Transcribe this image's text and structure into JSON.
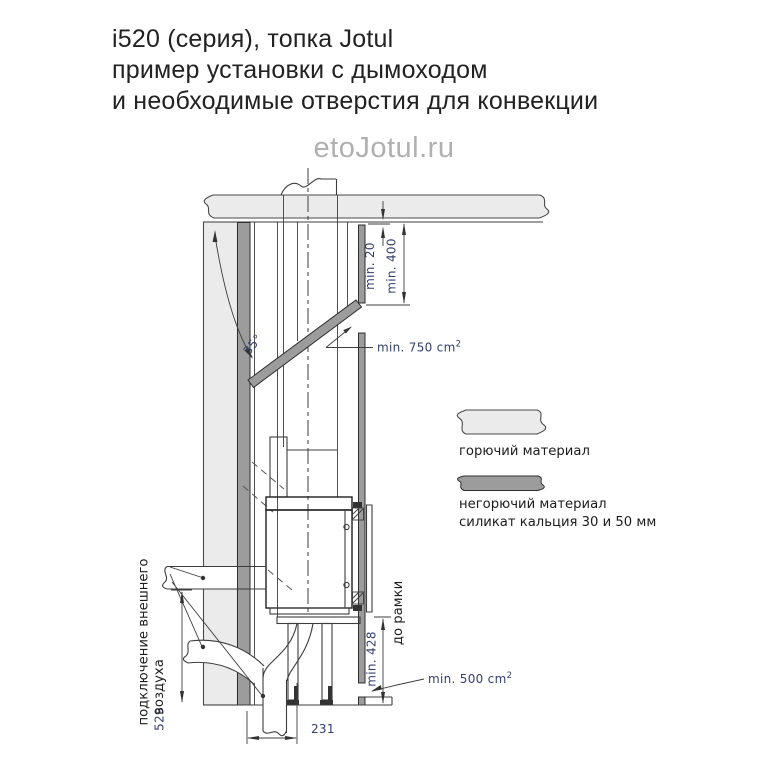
{
  "title": {
    "line1": "i520 (серия), топка Jotul",
    "line2": "пример установки с дымоходом",
    "line3": "и необходимые отверстия для конвекции"
  },
  "watermark": "etoJotul.ru",
  "dimensions": {
    "min20": "min. 20",
    "min400": "min. 400",
    "angle35": "35°",
    "min750": "min. 750 cm",
    "min750_sup": "2",
    "min500": "min. 500 cm",
    "min500_sup": "2",
    "min428": "min. 428",
    "dim529": "529",
    "dim231": "231"
  },
  "labels": {
    "to_frame": "до рамки",
    "air_line1": "подключение внешнего",
    "air_line2": "воздуха"
  },
  "legend": {
    "combustible": "горючий материал",
    "noncombustible_line1": "негорючий материал",
    "noncombustible_line2": "силикат кальция 30 и 50 мм"
  },
  "colors": {
    "combustible_fill": "#EBEBEB",
    "noncombustible_fill": "#9C9C9C",
    "line": "#3D3D3D",
    "dimension_text": "#333F6D",
    "title_text": "#222222",
    "watermark_text": "#B0B0B0"
  }
}
